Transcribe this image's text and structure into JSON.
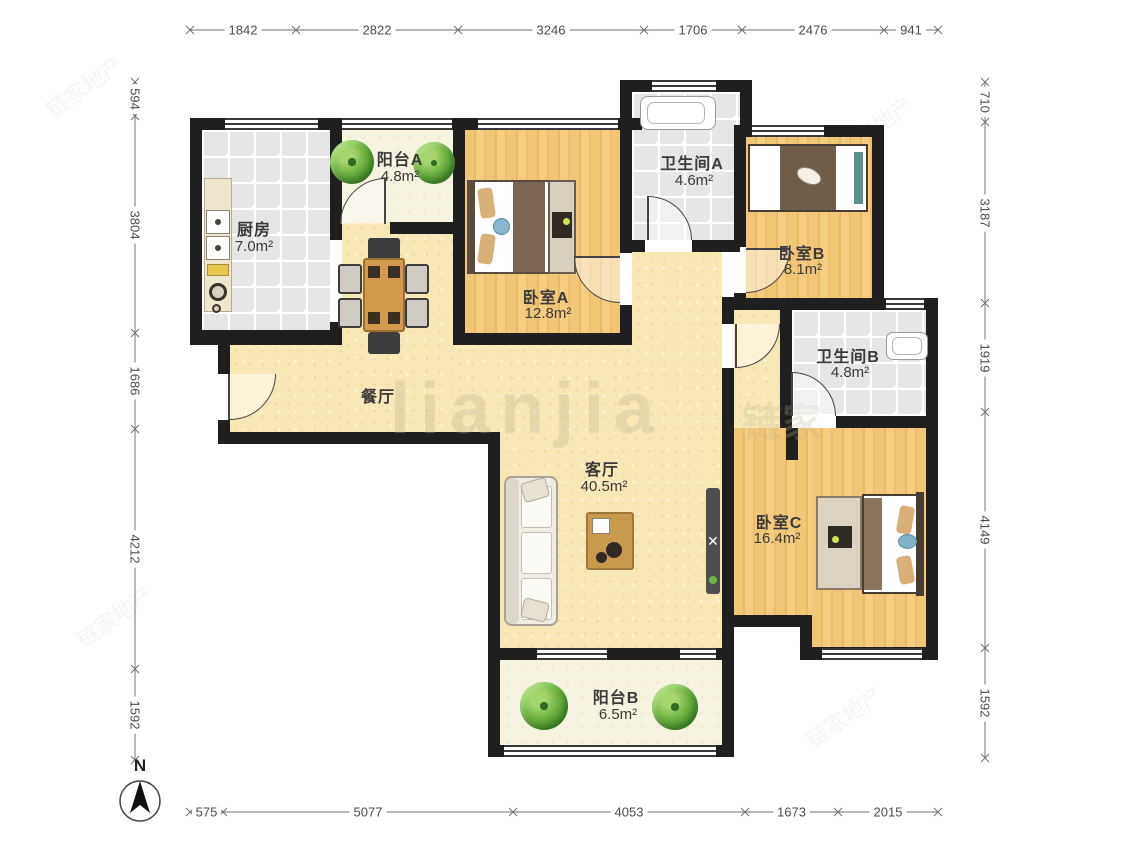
{
  "compass": {
    "label": "N"
  },
  "watermark": {
    "main": "lianjia",
    "cjk": "链家",
    "stamp": "链家地产"
  },
  "rooms": {
    "balcony_a": {
      "name": "阳台A",
      "area": "4.8m²"
    },
    "kitchen": {
      "name": "厨房",
      "area": "7.0m²"
    },
    "bedroom_a": {
      "name": "卧室A",
      "area": "12.8m²"
    },
    "bathroom_a": {
      "name": "卫生间A",
      "area": "4.6m²"
    },
    "bedroom_b": {
      "name": "卧室B",
      "area": "8.1m²"
    },
    "bathroom_b": {
      "name": "卫生间B",
      "area": "4.8m²"
    },
    "dining": {
      "name": "餐厅"
    },
    "living": {
      "name": "客厅",
      "area": "40.5m²"
    },
    "bedroom_c": {
      "name": "卧室C",
      "area": "16.4m²"
    },
    "balcony_b": {
      "name": "阳台B",
      "area": "6.5m²"
    }
  },
  "dimensions": {
    "top": [
      "1842",
      "2822",
      "3246",
      "1706",
      "2476",
      "941"
    ],
    "left": [
      "594",
      "3804",
      "1686",
      "4212",
      "1592"
    ],
    "right": [
      "710",
      "3187",
      "1919",
      "4149",
      "1592"
    ],
    "bottom": [
      "575",
      "5077",
      "4053",
      "1673",
      "2015"
    ]
  }
}
